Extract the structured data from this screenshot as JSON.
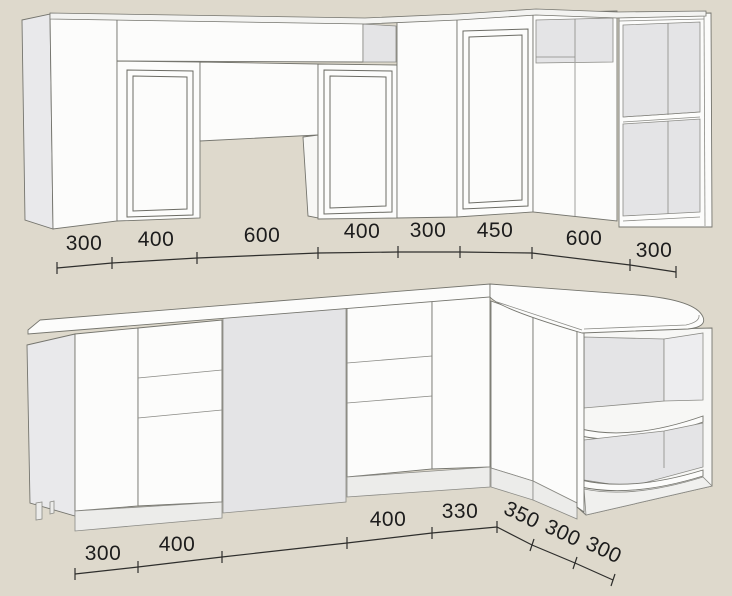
{
  "drawing": {
    "kind": "kitchen-cabinet-dimension-sketch",
    "views": [
      "upper-cabinet-row",
      "base-cabinet-row"
    ]
  },
  "colors": {
    "background": "#ded9cc",
    "cabinet_white": "#fcfcfb",
    "panel_gray": "#e4e4e6",
    "side_gray": "#e9e9eb",
    "outline": "#75756e",
    "dimension_text": "#1c1c1c"
  },
  "dims": {
    "upper": [
      "300",
      "400",
      "600",
      "400",
      "300",
      "450",
      "600",
      "300"
    ],
    "lower": [
      "300",
      "400",
      "400",
      "330"
    ],
    "lower_diagonal": [
      "350",
      "300",
      "300"
    ]
  }
}
